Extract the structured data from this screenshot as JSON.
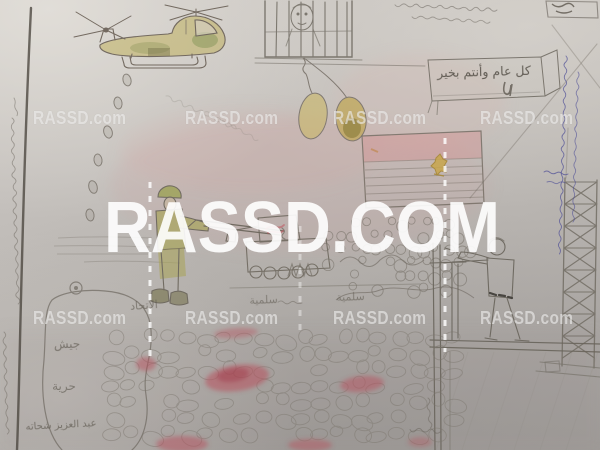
{
  "image": {
    "description": "Photograph of a child's pencil-and-crayon drawing of an Egyptian protest scene: a tandem-rotor helicopter dropping objects, a prisoner behind bars with balloons, an Egyptian flag, a soldier firing a rifle, a tank, crowds, stone/blood field, a rooftop shooter beside a lattice tower, and a speech bubble",
    "watermarks": {
      "small": "RASSD.com",
      "large": "RASSD.COM"
    },
    "handwriting": {
      "banner": "كل عام وأنتم بخير",
      "chant": "سلمية سلمية",
      "union_word": "الاتحاد",
      "bubble_word_1": "جيش",
      "bubble_word_2": "حرية",
      "signature": "عبد العزيز شحاته"
    }
  }
}
